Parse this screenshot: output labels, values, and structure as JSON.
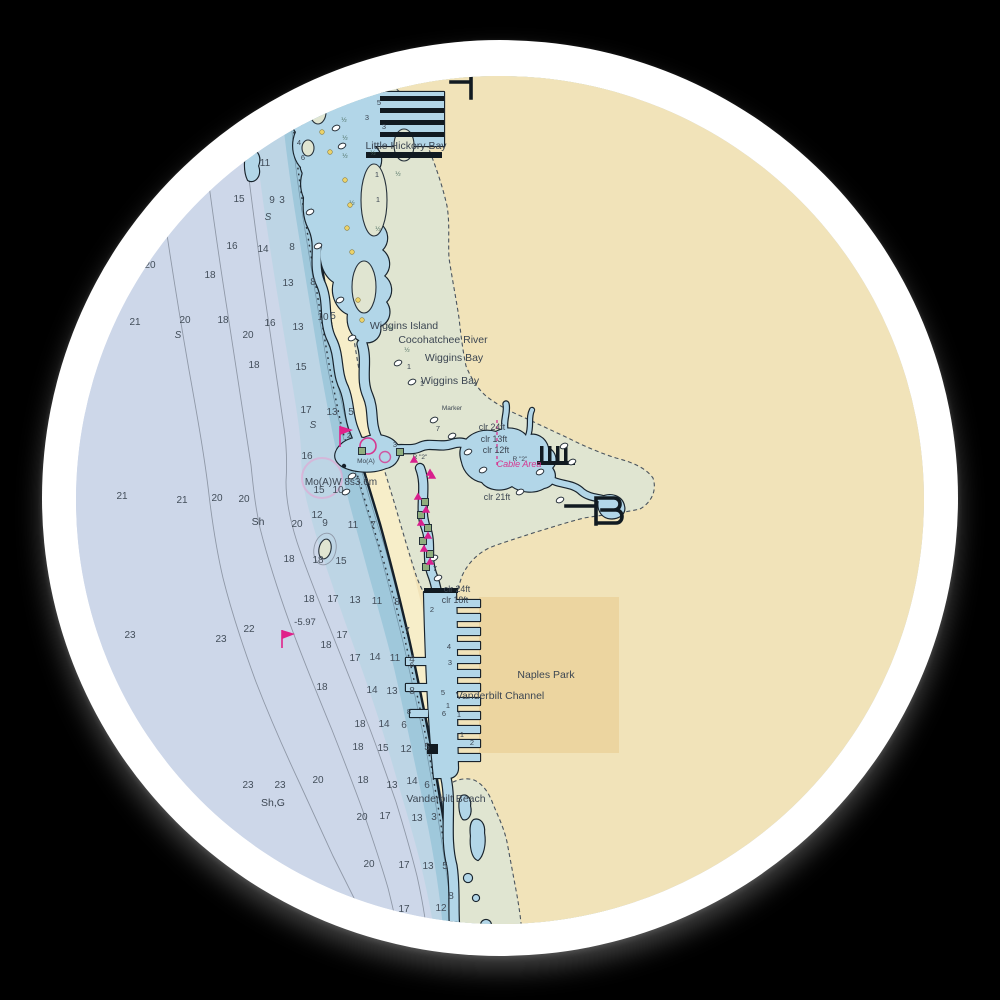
{
  "sticker": {
    "background": "#000000",
    "ring_color": "#ffffff"
  },
  "chart": {
    "colors": {
      "deep_water": "#cdd7e9",
      "mid_band": "#bdd5e5",
      "near_band": "#9fc8db",
      "estuary_water": "#b2d6e8",
      "beach": "#f7eec9",
      "land_buff": "#f1e3b9",
      "mangrove_green": "#e0e5d1",
      "built_up": "#ecd5a0",
      "magenta": "#d6368f",
      "ink": "#15202a"
    },
    "labels": {
      "little_hickory_bay": "Little Hickory Bay",
      "wiggins_island": "Wiggins Island",
      "cocohatchee_river": "Cocohatchee River",
      "wiggins_bay_1": "Wiggins Bay",
      "wiggins_bay_2": "Wiggins Bay",
      "marker": "Marker",
      "clr_24ft_a": "clr 24ft",
      "clr_13ft": "clr 13ft",
      "clr_12ft": "clr 12ft",
      "cable_area": "Cable Area",
      "clr_21ft": "clr 21ft",
      "clr_24ft_b": "clr 24ft",
      "clr_18ft": "clr 18ft",
      "naples_park": "Naples Park",
      "vanderbilt_channel": "Vanderbilt Channel",
      "vanderbilt_beach": "Vanderbilt Beach",
      "light_characteristic": "Mo(A)W 8s3.6m",
      "light_small": "Mo(A)",
      "bottom_sh": "Sh",
      "bottom_shg": "Sh,G",
      "benchmark_neg": "-5.97",
      "benchmark_pos": "5.96"
    },
    "soundings": [
      [
        150,
        268,
        "20"
      ],
      [
        135,
        325,
        "21"
      ],
      [
        210,
        278,
        "18"
      ],
      [
        239,
        202,
        "15"
      ],
      [
        265,
        166,
        "11"
      ],
      [
        272,
        203,
        "9"
      ],
      [
        282,
        203,
        "3"
      ],
      [
        232,
        249,
        "16"
      ],
      [
        263,
        252,
        "14"
      ],
      [
        292,
        250,
        "8"
      ],
      [
        288,
        286,
        "13"
      ],
      [
        313,
        285,
        "8"
      ],
      [
        185,
        323,
        "20"
      ],
      [
        223,
        323,
        "18"
      ],
      [
        270,
        326,
        "16"
      ],
      [
        298,
        330,
        "13"
      ],
      [
        323,
        320,
        "10"
      ],
      [
        333,
        319,
        "5"
      ],
      [
        248,
        338,
        "20"
      ],
      [
        254,
        368,
        "18"
      ],
      [
        301,
        370,
        "15"
      ],
      [
        122,
        499,
        "21"
      ],
      [
        182,
        503,
        "21"
      ],
      [
        217,
        501,
        "20"
      ],
      [
        244,
        502,
        "20"
      ],
      [
        306,
        413,
        "17"
      ],
      [
        332,
        415,
        "13"
      ],
      [
        351,
        415,
        "5"
      ],
      [
        307,
        459,
        "16"
      ],
      [
        319,
        493,
        "15"
      ],
      [
        338,
        493,
        "10"
      ],
      [
        297,
        527,
        "20"
      ],
      [
        317,
        518,
        "12"
      ],
      [
        325,
        526,
        "9"
      ],
      [
        353,
        528,
        "11"
      ],
      [
        373,
        528,
        "7"
      ],
      [
        289,
        562,
        "18"
      ],
      [
        318,
        563,
        "18"
      ],
      [
        341,
        564,
        "15"
      ],
      [
        130,
        638,
        "23"
      ],
      [
        221,
        642,
        "23"
      ],
      [
        249,
        632,
        "22"
      ],
      [
        309,
        602,
        "18"
      ],
      [
        333,
        602,
        "17"
      ],
      [
        355,
        603,
        "13"
      ],
      [
        377,
        604,
        "11"
      ],
      [
        397,
        605,
        "8"
      ],
      [
        342,
        638,
        "17"
      ],
      [
        326,
        648,
        "18"
      ],
      [
        407,
        634,
        "7"
      ],
      [
        355,
        661,
        "17"
      ],
      [
        375,
        660,
        "14"
      ],
      [
        395,
        661,
        "11"
      ],
      [
        412,
        662,
        "4"
      ],
      [
        322,
        690,
        "18"
      ],
      [
        372,
        693,
        "14"
      ],
      [
        392,
        694,
        "13"
      ],
      [
        412,
        694,
        "8"
      ],
      [
        360,
        727,
        "18"
      ],
      [
        384,
        727,
        "14"
      ],
      [
        404,
        728,
        "6"
      ],
      [
        358,
        750,
        "18"
      ],
      [
        383,
        751,
        "15"
      ],
      [
        406,
        752,
        "12"
      ],
      [
        427,
        750,
        "5"
      ],
      [
        248,
        788,
        "23"
      ],
      [
        280,
        788,
        "23"
      ],
      [
        318,
        783,
        "20"
      ],
      [
        363,
        783,
        "18"
      ],
      [
        392,
        788,
        "13"
      ],
      [
        412,
        784,
        "14"
      ],
      [
        427,
        788,
        "6"
      ],
      [
        362,
        820,
        "20"
      ],
      [
        385,
        819,
        "17"
      ],
      [
        417,
        821,
        "13"
      ],
      [
        434,
        820,
        "3"
      ],
      [
        369,
        867,
        "20"
      ],
      [
        404,
        868,
        "17"
      ],
      [
        428,
        869,
        "13"
      ],
      [
        445,
        869,
        "5"
      ],
      [
        451,
        899,
        "8"
      ],
      [
        404,
        912,
        "17"
      ],
      [
        441,
        911,
        "12"
      ],
      [
        430,
        937,
        "17"
      ]
    ],
    "channel_depths": [
      [
        379,
        105,
        "5"
      ],
      [
        367,
        120,
        "3"
      ],
      [
        384,
        129,
        "3"
      ],
      [
        299,
        145,
        "4"
      ],
      [
        303,
        160,
        "6"
      ],
      [
        377,
        177,
        "1"
      ],
      [
        378,
        202,
        "1"
      ],
      [
        409,
        369,
        "1"
      ],
      [
        422,
        386,
        "1"
      ],
      [
        438,
        431,
        "7"
      ],
      [
        395,
        447,
        "3"
      ],
      [
        349,
        438,
        "2"
      ],
      [
        435,
        571,
        "7"
      ],
      [
        432,
        612,
        "2"
      ],
      [
        412,
        667,
        "6"
      ],
      [
        449,
        649,
        "4"
      ],
      [
        450,
        665,
        "3"
      ],
      [
        443,
        695,
        "5"
      ],
      [
        448,
        708,
        "1"
      ],
      [
        444,
        716,
        "6"
      ],
      [
        459,
        717,
        "1"
      ],
      [
        462,
        737,
        "1"
      ],
      [
        472,
        745,
        "2"
      ],
      [
        409,
        714,
        "8"
      ]
    ],
    "fractions": [
      [
        344,
        122
      ],
      [
        345,
        140
      ],
      [
        345,
        158
      ],
      [
        373,
        155
      ],
      [
        378,
        231
      ],
      [
        352,
        205
      ],
      [
        398,
        176
      ],
      [
        407,
        352
      ],
      [
        390,
        330
      ]
    ],
    "sand_marks": [
      [
        268,
        220
      ],
      [
        178,
        338
      ],
      [
        313,
        428
      ]
    ],
    "marker_tags": [
      [
        420,
        459,
        "R \"2\""
      ],
      [
        520,
        461,
        "R \"2\""
      ]
    ],
    "symbols": {
      "rock_circles": [
        [
          330,
          108
        ],
        [
          336,
          128
        ],
        [
          342,
          146
        ],
        [
          310,
          212
        ],
        [
          318,
          246
        ],
        [
          340,
          300
        ],
        [
          352,
          338
        ],
        [
          398,
          363
        ],
        [
          412,
          382
        ],
        [
          434,
          420
        ],
        [
          452,
          436
        ],
        [
          468,
          452
        ],
        [
          483,
          470
        ],
        [
          520,
          492
        ],
        [
          540,
          472
        ],
        [
          434,
          558
        ],
        [
          438,
          578
        ],
        [
          560,
          500
        ],
        [
          352,
          476
        ],
        [
          346,
          492
        ],
        [
          564,
          446
        ],
        [
          572,
          462
        ]
      ],
      "yellow_dots": [
        [
          345,
          180
        ],
        [
          350,
          205
        ],
        [
          347,
          228
        ],
        [
          352,
          252
        ],
        [
          322,
          132
        ],
        [
          330,
          152
        ],
        [
          358,
          300
        ],
        [
          362,
          320
        ]
      ],
      "green_squares": [
        [
          362,
          451
        ],
        [
          400,
          452
        ],
        [
          425,
          502
        ],
        [
          421,
          515
        ],
        [
          428,
          528
        ],
        [
          423,
          541
        ],
        [
          430,
          554
        ],
        [
          426,
          567
        ]
      ],
      "magenta_triangles": [
        [
          414,
          460
        ],
        [
          430,
          473
        ],
        [
          418,
          497
        ],
        [
          426,
          510
        ],
        [
          421,
          523
        ],
        [
          428,
          536
        ],
        [
          424,
          549
        ],
        [
          430,
          562
        ],
        [
          432,
          476
        ]
      ]
    }
  }
}
